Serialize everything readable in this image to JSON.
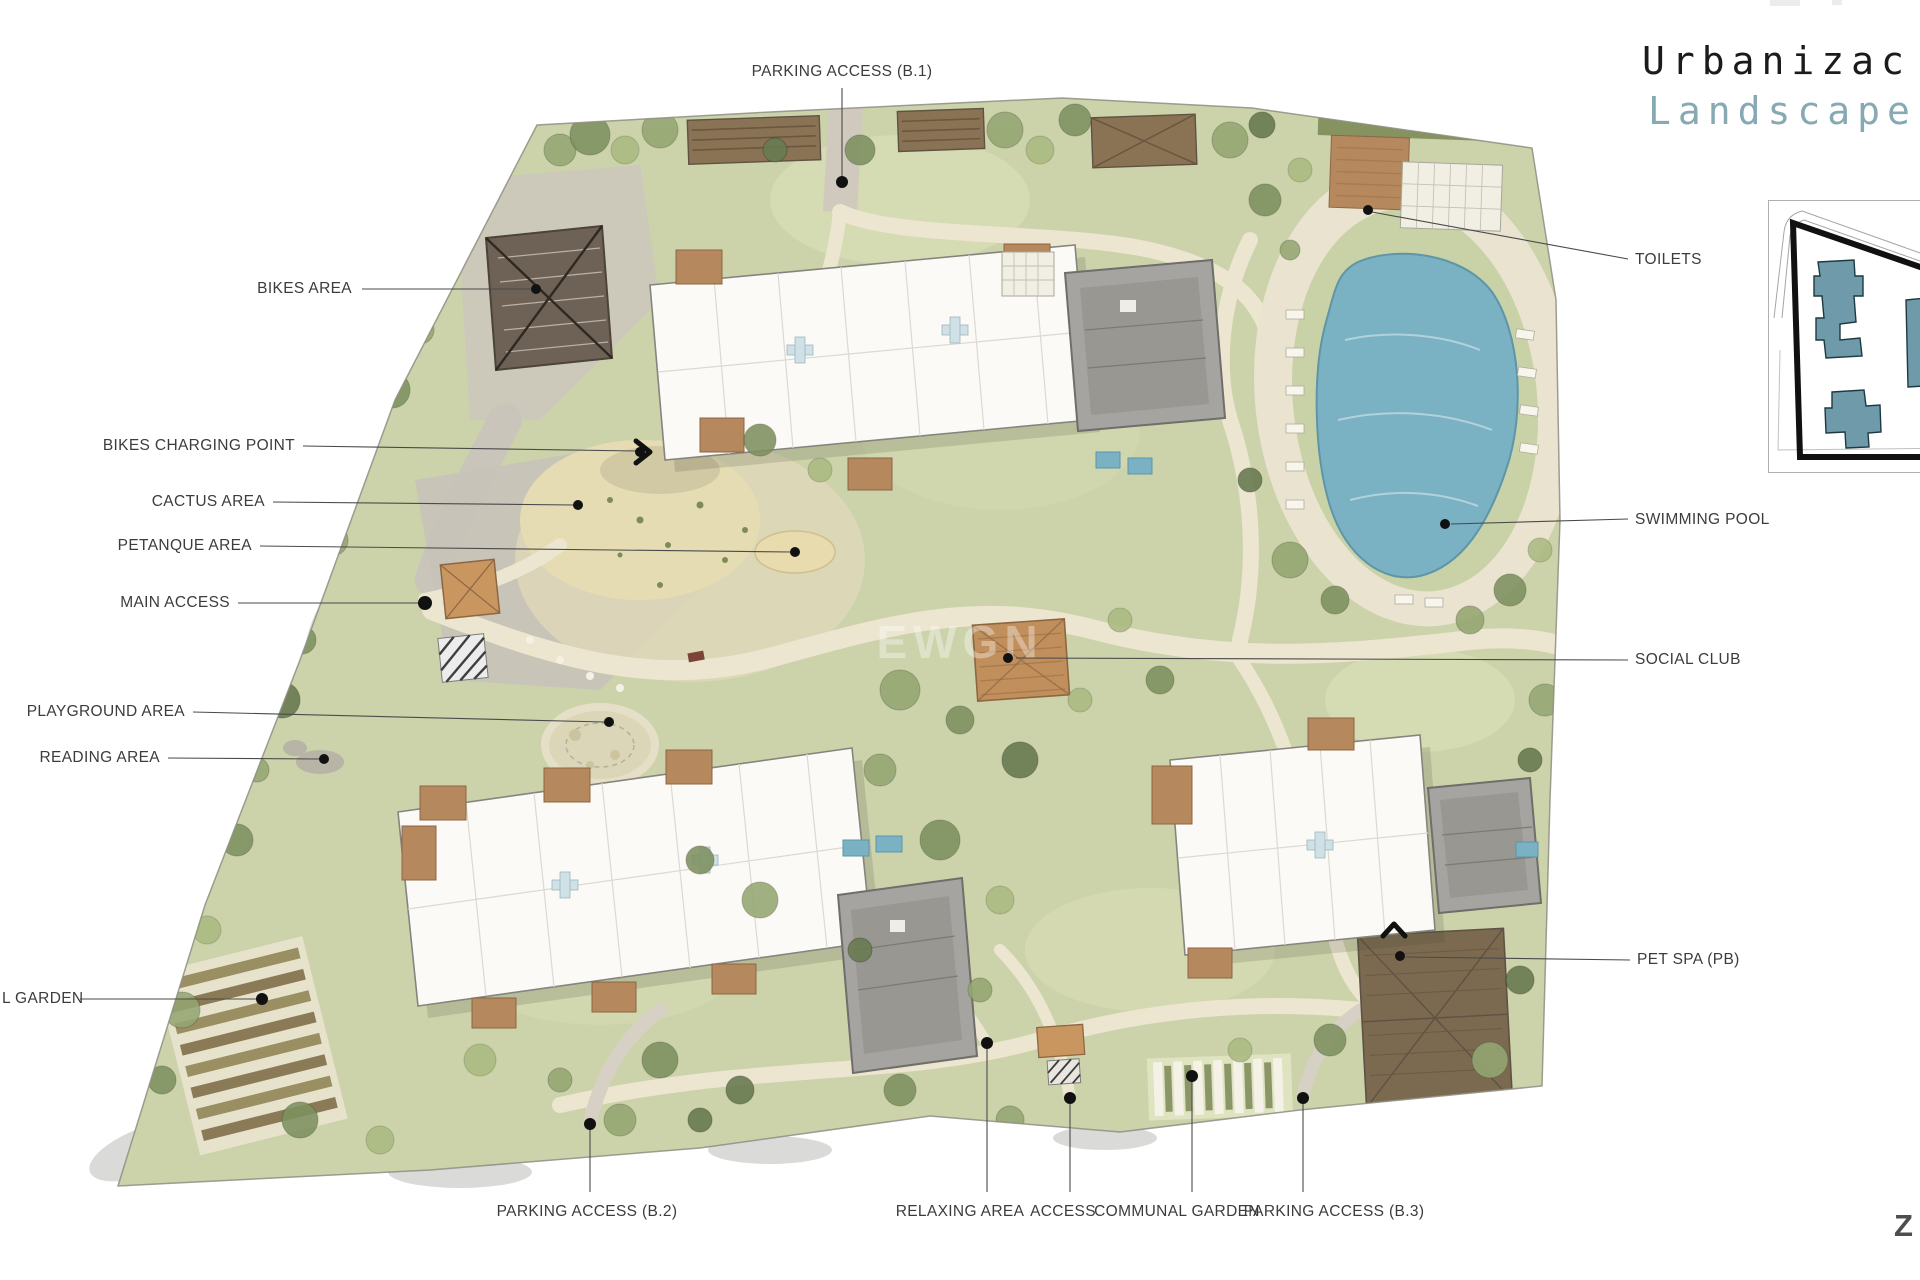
{
  "title": {
    "line1": "Urbanizac",
    "line2": "Landscape"
  },
  "watermark": {
    "text": "EWGN"
  },
  "corner_mark": {
    "text": "Z"
  },
  "palette": {
    "title_black": "#1b1b1b",
    "title_teal": "#87a9b3",
    "label_grey": "#3c3c3c",
    "leader_line": "#4a4a4a",
    "site_green": "#ccd3ab",
    "path_cream": "#ece6d0",
    "pool_blue": "#7ab1c3",
    "wood_brown": "#b5885e",
    "roof_grey": "#a5a4a0",
    "keymap_building_teal": "#6e9aa9"
  },
  "annotations": {
    "parking_b1": {
      "text": "PARKING ACCESS (B.1)"
    },
    "bikes_area": {
      "text": "BIKES AREA"
    },
    "bikes_charging_point": {
      "text": "BIKES CHARGING POINT"
    },
    "cactus_area": {
      "text": "CACTUS AREA"
    },
    "petanque_area": {
      "text": "PETANQUE AREA"
    },
    "main_access": {
      "text": "MAIN ACCESS"
    },
    "playground_area": {
      "text": "PLAYGROUND AREA"
    },
    "reading_area": {
      "text": "READING AREA"
    },
    "l_garden": {
      "text": "L GARDEN"
    },
    "parking_b2": {
      "text": "PARKING ACCESS (B.2)"
    },
    "relaxing_area": {
      "text": "RELAXING AREA"
    },
    "access": {
      "text": "ACCESS"
    },
    "communal_garden": {
      "text": "COMMUNAL GARDEN"
    },
    "parking_b3": {
      "text": "PARKING ACCESS (B.3)"
    },
    "toilets": {
      "text": "TOILETS"
    },
    "swimming_pool": {
      "text": "SWIMMING POOL"
    },
    "social_club": {
      "text": "SOCIAL CLUB"
    },
    "pet_spa": {
      "text": "PET SPA (PB)"
    }
  }
}
